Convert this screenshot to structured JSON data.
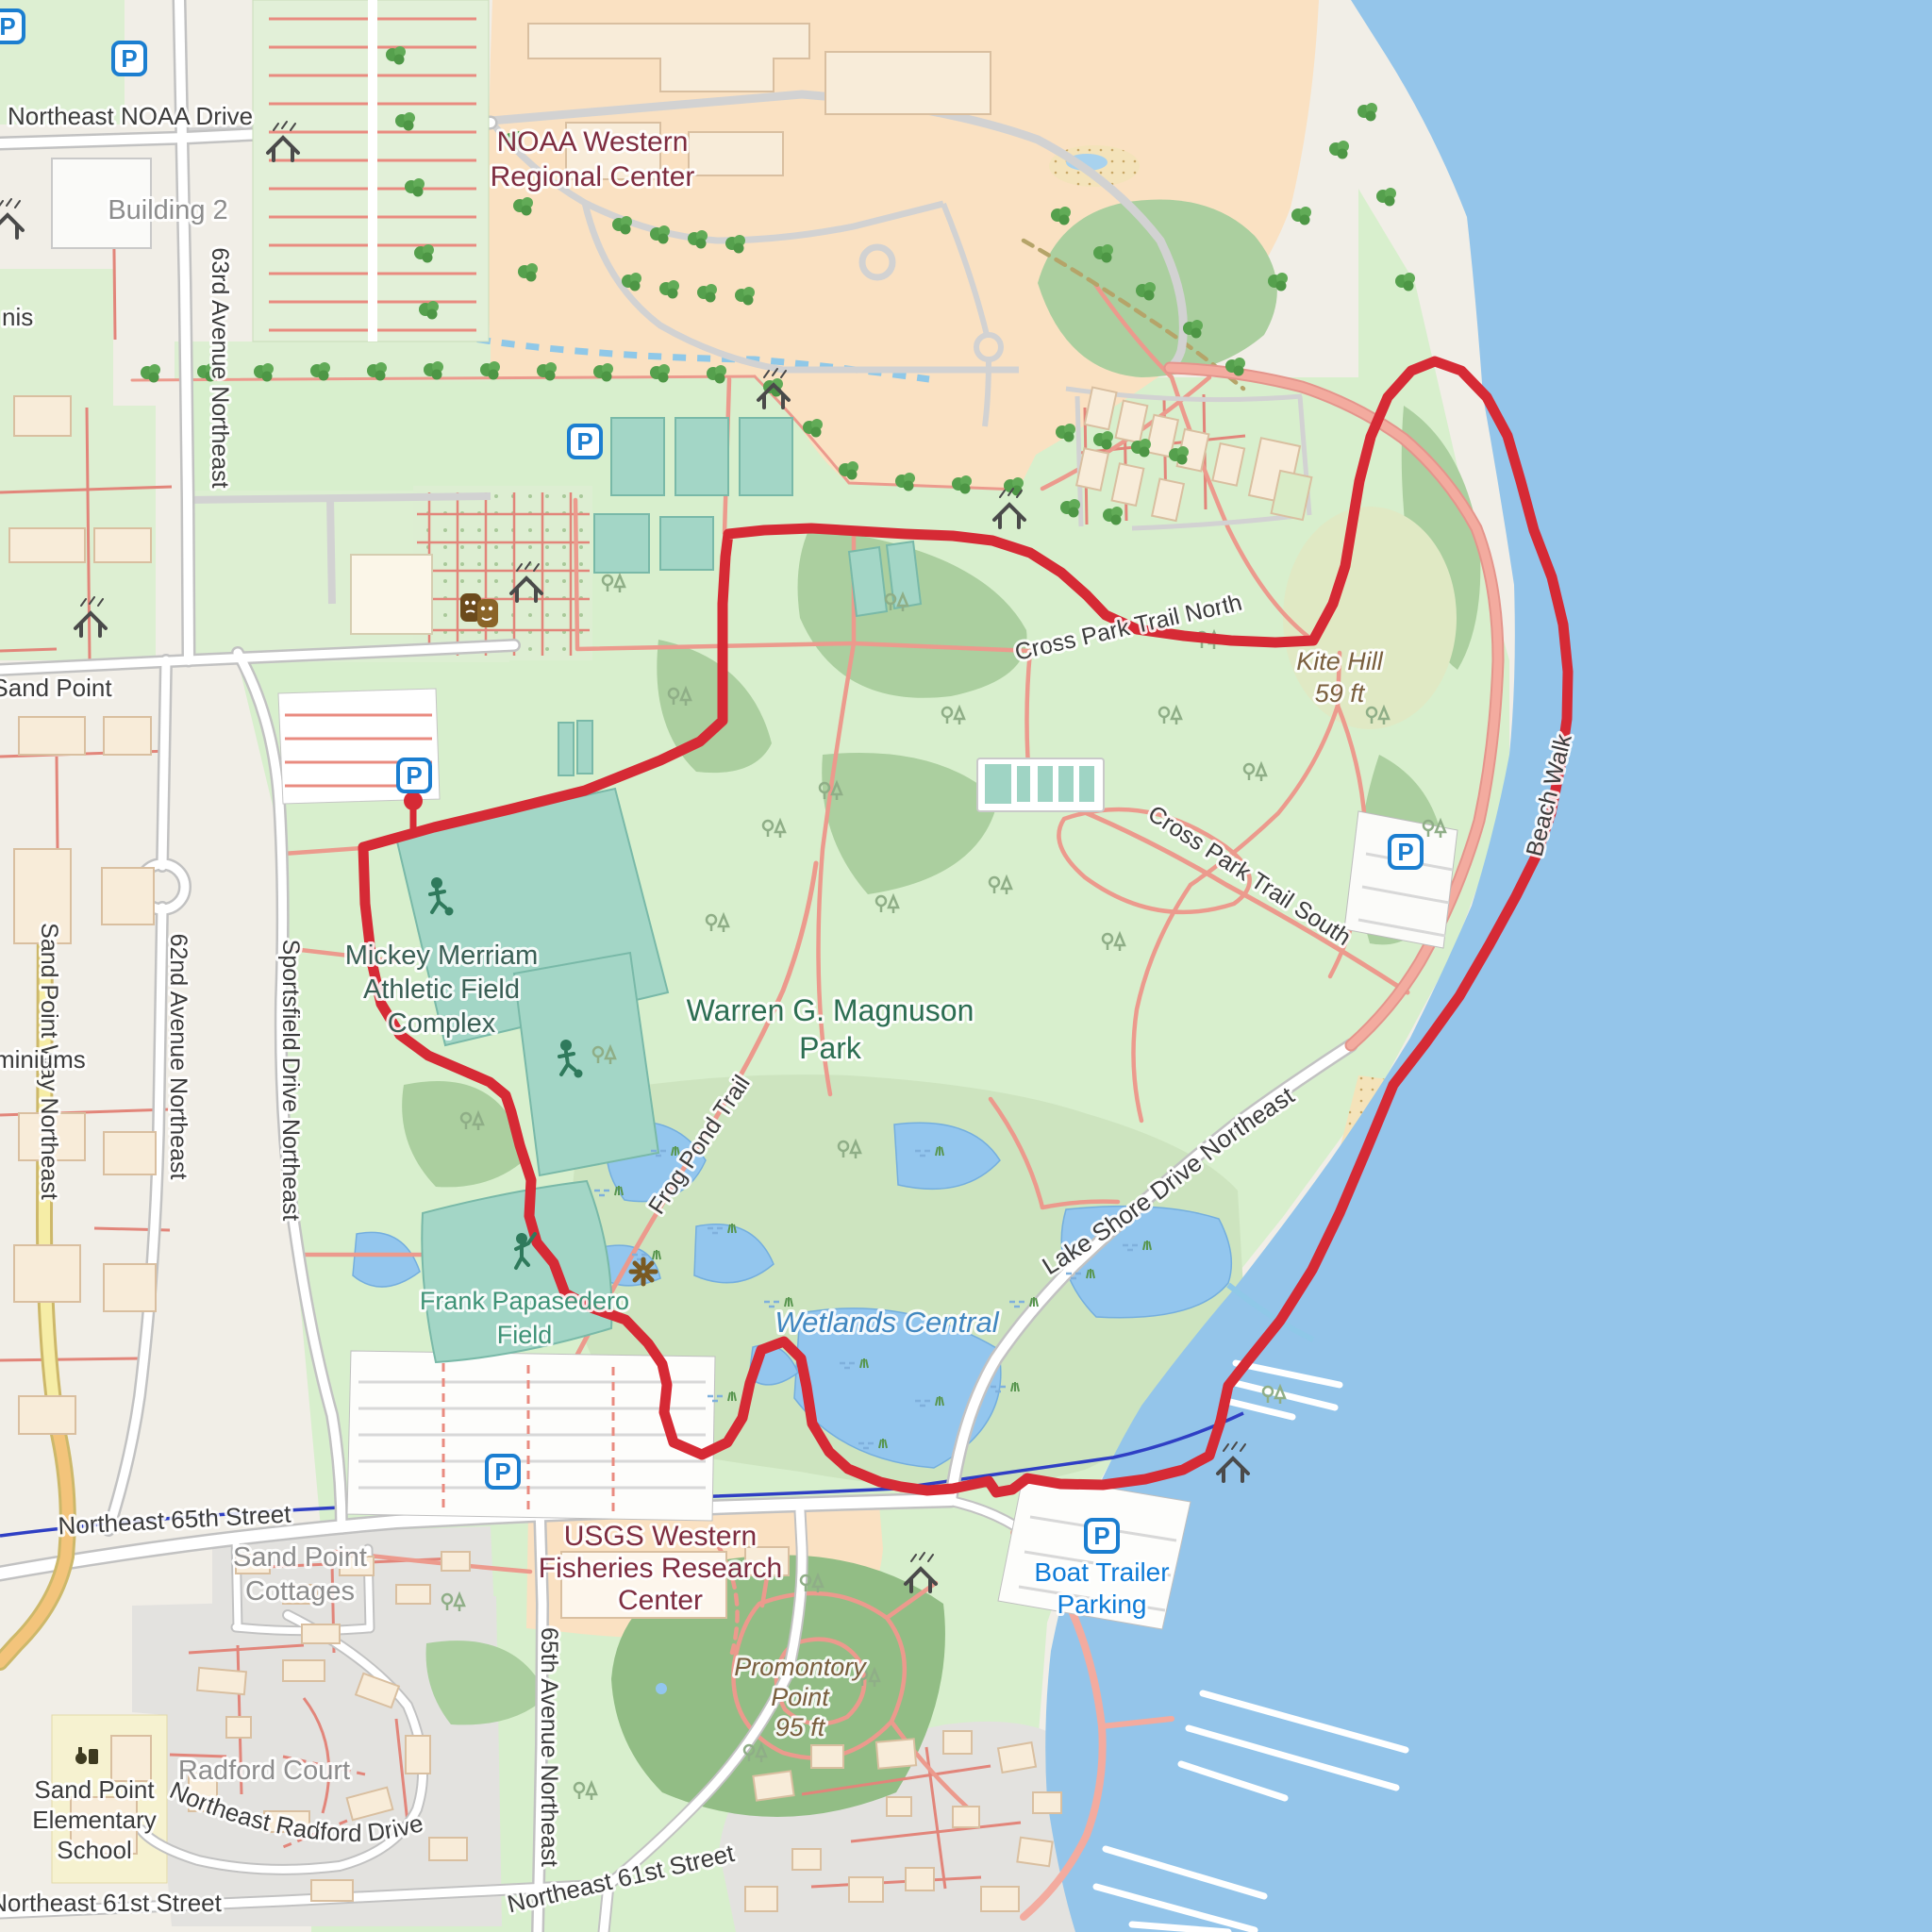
{
  "map": {
    "kind": "street map with GPS route overlay",
    "route_color": "#d62a35",
    "water_color": "#94c5ea",
    "park_color": "#d8efcd"
  },
  "icons": {
    "parking_glyph": "P"
  },
  "labels": {
    "noaa_drive": "Northeast NOAA Drive",
    "building2": "Building 2",
    "ave63": "63rd Avenue Northeast",
    "noaa_center_l1": "NOAA Western",
    "noaa_center_l2": "Regional Center",
    "tennis_partial": "nis",
    "sand_point": "Sand Point",
    "sand_point_way": "Sand Point Way Northeast",
    "ave62": "62nd Avenue Northeast",
    "sportsfield": "Sportsfield Drive Northeast",
    "condo_partial": "miniums",
    "mickey_l1": "Mickey Merriam",
    "mickey_l2": "Athletic Field",
    "mickey_l3": "Complex",
    "park_l1": "Warren G. Magnuson",
    "park_l2": "Park",
    "cross_north": "Cross Park Trail North",
    "cross_south": "Cross Park Trail South",
    "kite_hill_l1": "Kite Hill",
    "kite_hill_l2": "59 ft",
    "beach_walk": "Beach Walk",
    "lake_shore": "Lake Shore Drive Northeast",
    "frog_pond": "Frog Pond Trail",
    "frank_l1": "Frank Papasedero",
    "frank_l2": "Field",
    "wetlands": "Wetlands Central",
    "st65": "Northeast 65th Street",
    "usgs_l1": "USGS Western",
    "usgs_l2": "Fisheries Research",
    "usgs_l3": "Center",
    "cottages_l1": "Sand Point",
    "cottages_l2": "Cottages",
    "boat_l1": "Boat Trailer",
    "boat_l2": "Parking",
    "promontory_l1": "Promontory",
    "promontory_l2": "Point",
    "promontory_l3": "95 ft",
    "ave65": "65th Avenue Northeast",
    "radford_court": "Radford Court",
    "radford_drive": "Northeast Radford Drive",
    "school_l1": "Sand Point",
    "school_l2": "Elementary",
    "school_l3": "School",
    "st61_left": "Northeast 61st Street",
    "st61_right": "Northeast 61st Street"
  }
}
